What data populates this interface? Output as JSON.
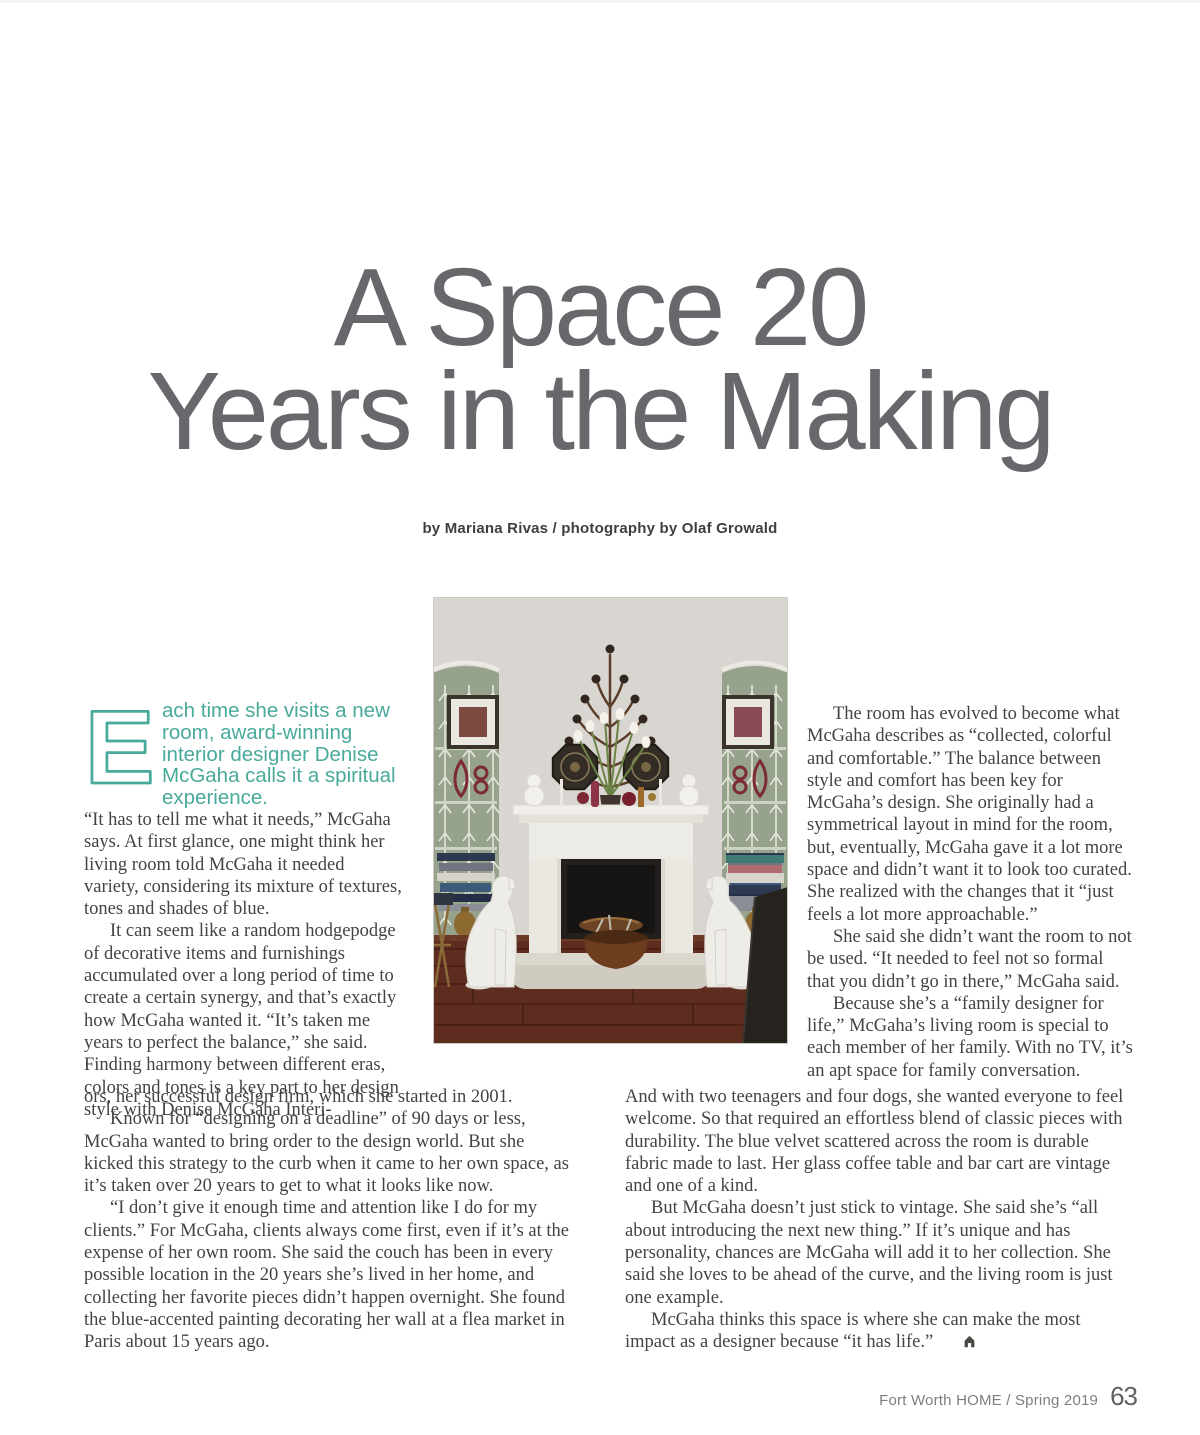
{
  "page": {
    "title_line1": "A Space 20",
    "title_line2": "Years in the Making",
    "byline": "by Mariana Rivas / photography by Olaf Growald",
    "footer": {
      "publication": "Fort Worth HOME / Spring 2019",
      "page_number": "63"
    }
  },
  "article": {
    "intro": {
      "drop_cap": "E",
      "lead_text": "ach time she visits a new room, award-winning interior designer Denise McGaha calls it a spiritual experience."
    },
    "left_narrow": {
      "paragraphs": [
        "“It has to tell me what it needs,” McGaha says. At first glance, one might think her living room told McGaha it needed variety, considering its mixture of textures, tones and shades of blue.",
        "It can seem like a random hodgepodge of decorative items and furnishings accumulated over a long period of time to create a certain synergy, and that’s exactly how McGaha wanted it. “It’s taken me years to perfect the balance,” she said. Finding harmony between different eras, colors and tones is a key part to her design style with Denise McGaha Interi-"
      ]
    },
    "left_wide": {
      "paragraphs": [
        "ors, her successful design firm, which she started in 2001.",
        "Known for “designing on a deadline” of 90 days or less, McGaha wanted to bring order to the design world. But she kicked this strategy to the curb when it came to her own space, as it’s taken over 20 years to get to what it looks like now.",
        "“I don’t give it enough time and attention like I do for my clients.” For McGaha, clients always come first, even if it’s at the expense of her own room. She said the couch has been in every possible location in the 20 years she’s lived in her home, and collecting her favorite pieces didn’t happen overnight. She found the blue-accented painting decorating her wall at a flea market in Paris about 15 years ago."
      ]
    },
    "right_narrow": {
      "paragraphs": [
        "The room has evolved to become what McGaha describes as “collected, colorful and comfortable.” The balance between style and comfort has been key for McGaha’s design. She originally had a symmetrical layout in mind for the room, but, eventually, McGaha gave it a lot more space and didn’t want it to look too curated. She realized with the changes that it “just feels a lot more approachable.”",
        "She said she didn’t want the room to not be used. “It needed to feel not so formal that you didn’t go in there,” McGaha said.",
        "Because she’s a “family designer for life,” McGaha’s living room is special to each member of her family. With no TV, it’s an apt space for family conversation."
      ]
    },
    "right_wide": {
      "paragraphs": [
        "And with two teenagers and four dogs, she wanted everyone to feel welcome. So that required an effortless blend of classic pieces with durability. The blue velvet scattered across the room is durable fabric made to last. Her glass coffee table and bar cart are vintage and one of a kind.",
        "But McGaha doesn’t just stick to vintage. She said she’s “all about introducing the next new thing.” If it’s unique and has personality, chances are McGaha will add it to her collection. She said she loves to be ahead of the curve, and the living room is just one example.",
        "McGaha thinks this space is where she can make the most impact as a designer because “it has life.”"
      ]
    },
    "end_mark_icon": "house-icon"
  },
  "colors": {
    "accent_teal": "#49a99b",
    "title_gray": "#66686b",
    "body_text": "#454340"
  }
}
